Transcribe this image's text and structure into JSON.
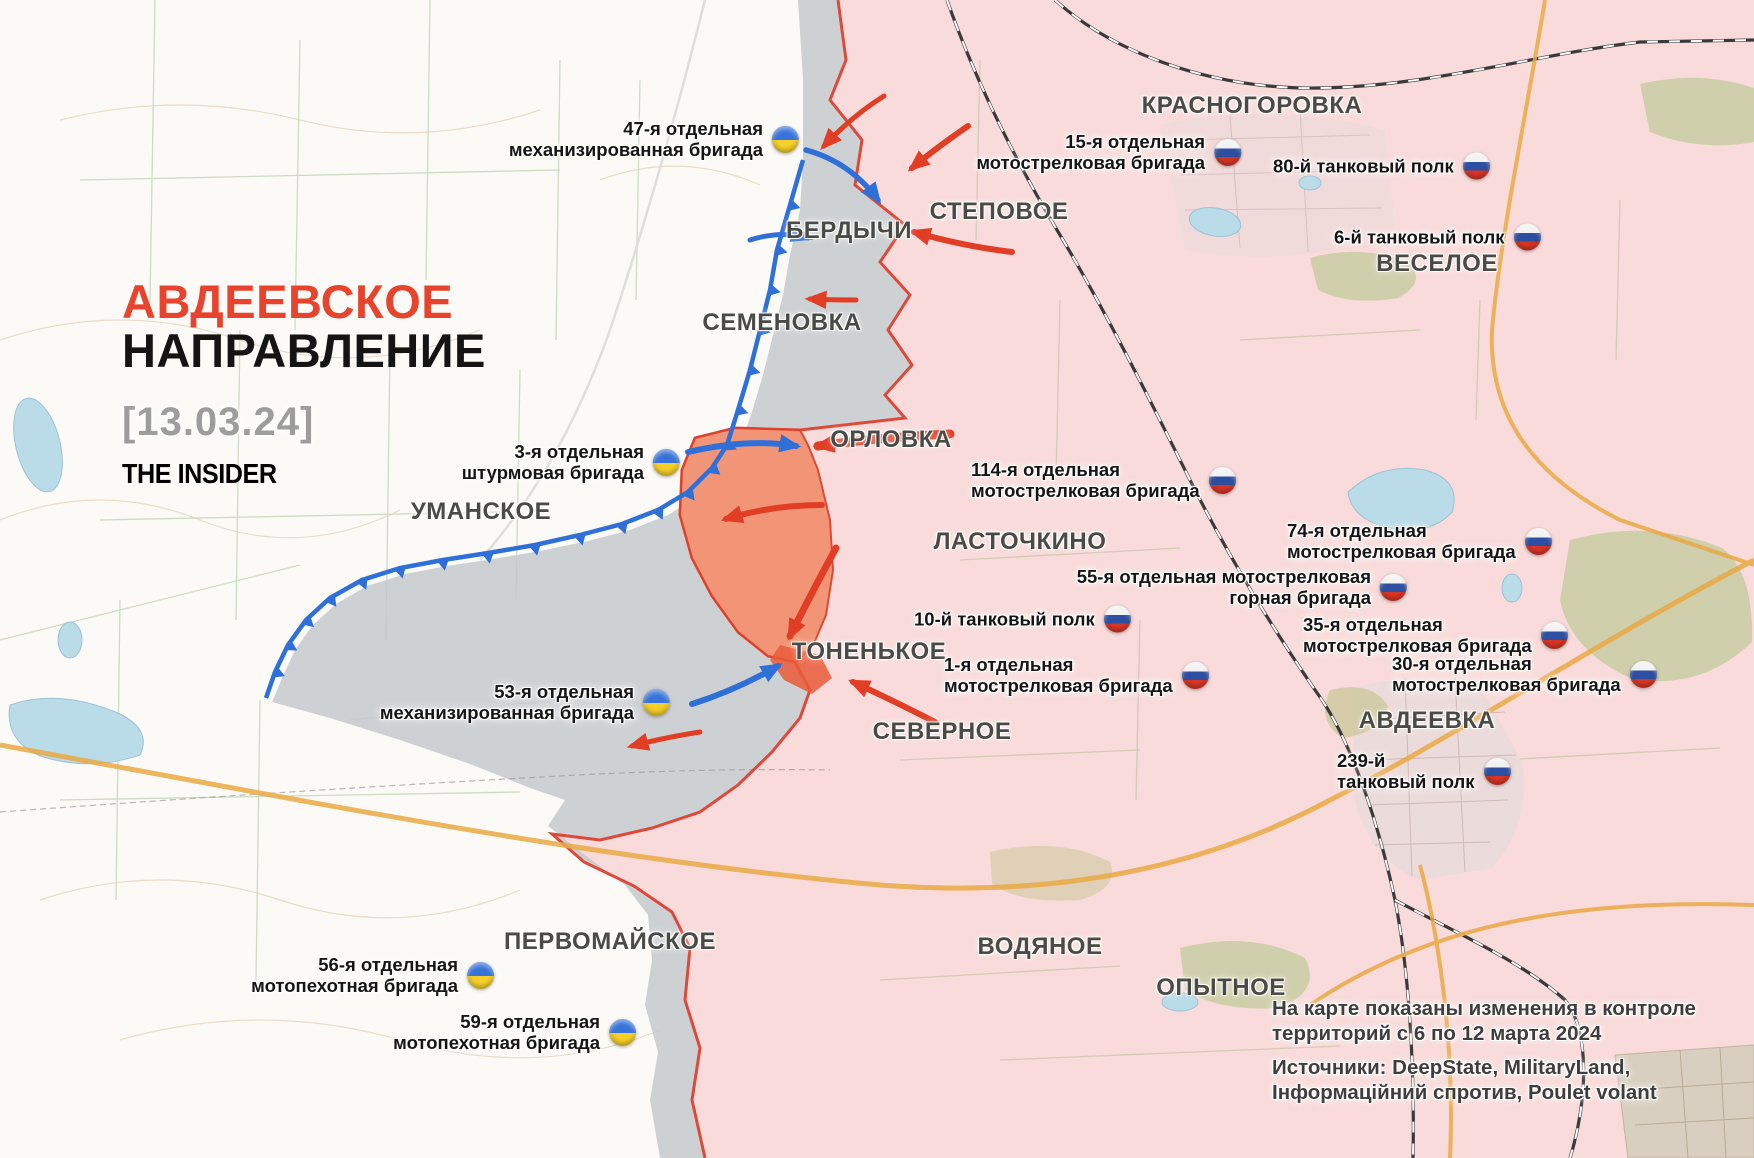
{
  "map_type": "military-front-map",
  "title": {
    "line1": "АВДЕЕВСКОЕ",
    "line2": "НАПРАВЛЕНИЕ",
    "date": "[13.03.24]",
    "brand": "THE INSIDER"
  },
  "note": {
    "line1": "На карте показаны изменения в контроле",
    "line2": "территорий с 6 по 12 марта 2024",
    "line3": "Источники: DeepState, MilitaryLand,",
    "line4": "Інформаційний спротив, Poulet volant"
  },
  "colors": {
    "title_red": "#e8432d",
    "russian_area_pink": "#f8dbda",
    "front_line_red": "#dd4a3a",
    "contested_gray": "#c3c7ca",
    "recent_advance_orange": "#f29272",
    "ukraine_line_blue": "#2f6fd8",
    "road_orange": "#eaa943",
    "water_blue": "#badbe8"
  },
  "towns": [
    {
      "id": "berdychi",
      "name": "БЕРДЫЧИ",
      "x": 849,
      "y": 231
    },
    {
      "id": "stepovoe",
      "name": "СТЕПОВОЕ",
      "x": 999,
      "y": 212
    },
    {
      "id": "krasnogorovka",
      "name": "КРАСНОГОРОВКА",
      "x": 1252,
      "y": 106
    },
    {
      "id": "veseloe",
      "name": "ВЕСЕЛОЕ",
      "x": 1437,
      "y": 264
    },
    {
      "id": "semenovka",
      "name": "СЕМЕНОВКА",
      "x": 782,
      "y": 323
    },
    {
      "id": "orlovka",
      "name": "ОРЛОВКА",
      "x": 891,
      "y": 440
    },
    {
      "id": "umanskoe",
      "name": "УМАНСКОЕ",
      "x": 481,
      "y": 512
    },
    {
      "id": "lastochkino",
      "name": "ЛАСТОЧКИНО",
      "x": 1020,
      "y": 542
    },
    {
      "id": "tonenkoe",
      "name": "ТОНЕНЬКОЕ",
      "x": 869,
      "y": 652
    },
    {
      "id": "severnoe",
      "name": "СЕВЕРНОЕ",
      "x": 942,
      "y": 732
    },
    {
      "id": "avdeevka",
      "name": "АВДЕЕВКА",
      "x": 1427,
      "y": 721
    },
    {
      "id": "pervomayskoe",
      "name": "ПЕРВОМАЙСКОЕ",
      "x": 610,
      "y": 942
    },
    {
      "id": "vodyanoe",
      "name": "ВОДЯНОЕ",
      "x": 1040,
      "y": 947
    },
    {
      "id": "opytnoe",
      "name": "ОПЫТНОЕ",
      "x": 1221,
      "y": 988
    }
  ],
  "units": [
    {
      "id": "ua-47",
      "flag": "ua",
      "side": "right",
      "x": 785,
      "y": 139,
      "lines": [
        "47-я отдельная",
        "механизированная бригада"
      ]
    },
    {
      "id": "ua-3",
      "flag": "ua",
      "side": "right",
      "x": 666,
      "y": 462,
      "lines": [
        "3-я отдельная",
        "штурмовая бригада"
      ]
    },
    {
      "id": "ua-53",
      "flag": "ua",
      "side": "right",
      "x": 656,
      "y": 702,
      "lines": [
        "53-я отдельная",
        "механизированная бригада"
      ]
    },
    {
      "id": "ua-56",
      "flag": "ua",
      "side": "right",
      "x": 480,
      "y": 975,
      "lines": [
        "56-я отдельная",
        "мотопехотная бригада"
      ]
    },
    {
      "id": "ua-59",
      "flag": "ua",
      "side": "right",
      "x": 622,
      "y": 1032,
      "lines": [
        "59-я отдельная",
        "мотопехотная бригада"
      ]
    },
    {
      "id": "ru-15",
      "flag": "ru",
      "side": "right",
      "x": 1227,
      "y": 152,
      "lines": [
        "15-я отдельная",
        "мотострелковая бригада"
      ]
    },
    {
      "id": "ru-80",
      "flag": "ru",
      "side": "left",
      "x": 1287,
      "y": 166,
      "lines": [
        "80-й танковый полк"
      ]
    },
    {
      "id": "ru-6",
      "flag": "ru",
      "side": "left",
      "x": 1348,
      "y": 237,
      "lines": [
        "6-й танковый полк"
      ]
    },
    {
      "id": "ru-114",
      "flag": "ru",
      "side": "left",
      "x": 985,
      "y": 480,
      "lines": [
        "114-я отдельная",
        "мотострелковая бригада"
      ]
    },
    {
      "id": "ru-74",
      "flag": "ru",
      "side": "left",
      "x": 1301,
      "y": 541,
      "lines": [
        "74-я отдельная",
        "мотострелковая бригада"
      ]
    },
    {
      "id": "ru-55",
      "flag": "ru",
      "side": "right",
      "x": 1393,
      "y": 587,
      "lines": [
        "55-я отдельная мотострелковая",
        "горная бригада"
      ]
    },
    {
      "id": "ru-10",
      "flag": "ru",
      "side": "left",
      "x": 928,
      "y": 619,
      "lines": [
        "10-й танковый полк"
      ]
    },
    {
      "id": "ru-35",
      "flag": "ru",
      "side": "left",
      "x": 1317,
      "y": 635,
      "lines": [
        "35-я отдельная",
        "мотострелковая бригада"
      ]
    },
    {
      "id": "ru-1",
      "flag": "ru",
      "side": "left",
      "x": 958,
      "y": 675,
      "lines": [
        "1-я отдельная",
        "мотострелковая бригада"
      ]
    },
    {
      "id": "ru-30",
      "flag": "ru",
      "side": "left",
      "x": 1406,
      "y": 674,
      "lines": [
        "30-я отдельная",
        "мотострелковая бригада"
      ]
    },
    {
      "id": "ru-239",
      "flag": "ru",
      "side": "left",
      "x": 1351,
      "y": 771,
      "lines": [
        "239-й",
        "танковый полк"
      ]
    }
  ]
}
